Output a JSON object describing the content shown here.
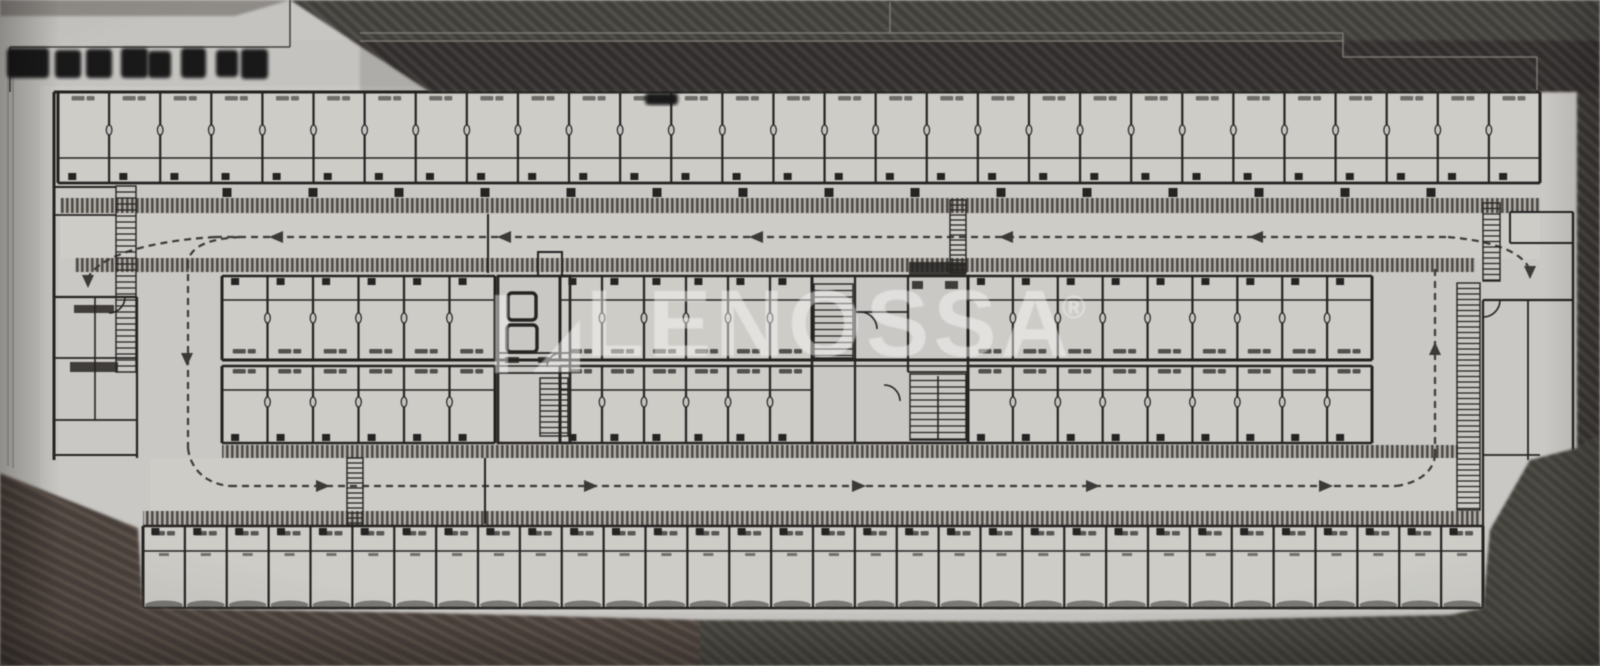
{
  "photo": {
    "description": "photographed architectural floor plan of a long storage-unit building with two drive aisles",
    "watermark": {
      "text": "LENOSSA",
      "registered_symbol": "®",
      "logo": "lenossa-mark",
      "color": "#ffffff",
      "opacity": 0.45
    },
    "redactions": {
      "title_block_blobs": 8,
      "unit_label_blobs": 1,
      "note": "title text blacked out"
    },
    "labels_note": "all unit labels are tiny and illegible smudges"
  },
  "colors": {
    "paper": "#c7c5c1",
    "paper_light": "#cccac6",
    "unit_fill": "#d3d1cc",
    "ink": "#23211f",
    "ink_soft": "#3a3836",
    "smudge": "#3b3936",
    "band_bg": "#b7b3ae",
    "band_tick": "#4e4a45",
    "hatch_top_bg": "#34322f",
    "hatch_top_line": "#524d48",
    "hatch_brown_bg": "#473d37",
    "hatch_brown_line": "#65564d",
    "hatch_olive_bg": "#3f3e38",
    "hatch_olive_line": "#56544b",
    "faint_line": "#857f78",
    "crisp_line": "#45433f",
    "redaction": "#131216",
    "gray_strip": "#8a8682",
    "shadow_blob": "#33312c"
  },
  "plan": {
    "canvas": {
      "w": 1600,
      "h": 666
    },
    "base_rect": [
      40,
      86,
      1537,
      527
    ],
    "aisle_fills": [
      [
        60,
        214,
        1480,
        45
      ],
      [
        150,
        458,
        1330,
        54
      ]
    ],
    "rows": [
      {
        "name": "top-units",
        "segments": [
          [
            58,
            1540,
            29
          ]
        ],
        "y0": 92,
        "y1": 183,
        "inner_line_y": 158,
        "label_y": 96,
        "label_opacity": 0.65,
        "tick_y": 173,
        "oval_y": 130
      },
      {
        "name": "mid-upper-units",
        "segments": [
          [
            222,
            495,
            6
          ],
          [
            560,
            812,
            6
          ],
          [
            968,
            1372,
            9
          ]
        ],
        "y0": 276,
        "y1": 360,
        "inner_line_y": 300,
        "label_y": 349,
        "label_opacity": 0.85,
        "tick_y": 278,
        "oval_y": 318
      },
      {
        "name": "mid-lower-units",
        "segments": [
          [
            222,
            495,
            6
          ],
          [
            560,
            812,
            6
          ],
          [
            968,
            1372,
            9
          ]
        ],
        "y0": 366,
        "y1": 443,
        "inner_line_y": 390,
        "label_y": 369,
        "label_opacity": 0.85,
        "tick_y": 434,
        "oval_y": 402
      },
      {
        "name": "bottom-units",
        "segments": [
          [
            143,
            1483,
            32
          ]
        ],
        "y0": 526,
        "y1": 608,
        "inner_line_y": 551,
        "label_y": 531,
        "label_opacity": 0.8,
        "tick_y": 528,
        "dash_y": 553,
        "shadow_y": 605
      }
    ],
    "hatch_bands": [
      [
        60,
        198,
        1480,
        15
      ],
      [
        75,
        258,
        1400,
        14
      ],
      [
        222,
        445,
        1236,
        13
      ],
      [
        143,
        511,
        1338,
        14
      ]
    ],
    "nub_ticks": {
      "y": 188,
      "size": 9,
      "xs": [
        227,
        313,
        399,
        485,
        571,
        657,
        743,
        829,
        915,
        1001,
        1087,
        1173,
        1259,
        1345,
        1431
      ]
    },
    "routes": [
      "M 215 237 H 1448",
      "M 240 237 C 205 239 190 248 188 262",
      "M 188 262 V 448",
      "M 188 448 C 190 468 205 484 230 486",
      "M 230 486 H 1396",
      "M 1396 486 C 1418 483 1433 472 1435 456",
      "M 1435 456 V 268",
      "M 215 237 C 152 241 103 254 89 276",
      "M 1448 237 C 1494 241 1521 252 1529 268"
    ],
    "arrows": [
      {
        "x": 277,
        "y": 237,
        "dir": "left"
      },
      {
        "x": 505,
        "y": 237,
        "dir": "left"
      },
      {
        "x": 757,
        "y": 237,
        "dir": "left"
      },
      {
        "x": 1007,
        "y": 237,
        "dir": "left"
      },
      {
        "x": 1257,
        "y": 237,
        "dir": "left"
      },
      {
        "x": 322,
        "y": 486,
        "dir": "right"
      },
      {
        "x": 590,
        "y": 486,
        "dir": "right"
      },
      {
        "x": 858,
        "y": 486,
        "dir": "right"
      },
      {
        "x": 1092,
        "y": 486,
        "dir": "right"
      },
      {
        "x": 1325,
        "y": 486,
        "dir": "right"
      },
      {
        "x": 88,
        "y": 280,
        "dir": "down"
      },
      {
        "x": 1530,
        "y": 271,
        "dir": "down"
      },
      {
        "x": 187,
        "y": 358,
        "dir": "down"
      },
      {
        "x": 1435,
        "y": 350,
        "dir": "up"
      }
    ],
    "walls": [
      [
        54,
        92,
        1540,
        92,
        3
      ],
      [
        54,
        92,
        54,
        460,
        3
      ],
      [
        58,
        183,
        1540,
        183,
        2.4
      ],
      [
        1540,
        92,
        1540,
        183,
        2.4
      ],
      [
        222,
        360,
        1372,
        360,
        3
      ],
      [
        222,
        366,
        1372,
        366,
        1.6
      ],
      [
        488,
        214,
        488,
        273,
        2
      ],
      [
        485,
        458,
        485,
        524,
        2
      ],
      [
        855,
        276,
        855,
        443,
        2.2
      ],
      [
        908,
        276,
        908,
        372,
        2.2
      ],
      [
        855,
        312,
        908,
        312,
        1.8
      ],
      [
        908,
        372,
        968,
        372,
        1.8
      ],
      [
        938,
        376,
        938,
        440,
        1.6
      ],
      [
        498,
        353,
        570,
        353,
        1.8
      ],
      [
        498,
        373,
        570,
        373,
        1.8
      ],
      [
        53,
        187,
        116,
        187,
        2
      ],
      [
        53,
        215,
        116,
        215,
        1.8
      ],
      [
        53,
        297,
        137,
        297,
        2.2
      ],
      [
        137,
        297,
        137,
        458,
        2.2
      ],
      [
        53,
        358,
        137,
        358,
        1.8
      ],
      [
        53,
        420,
        137,
        420,
        1.8
      ],
      [
        53,
        455,
        137,
        455,
        2
      ],
      [
        95,
        297,
        95,
        420,
        1.6
      ],
      [
        1483,
        300,
        1573,
        300,
        2.2
      ],
      [
        1483,
        300,
        1483,
        528,
        2.2
      ],
      [
        1573,
        212,
        1573,
        450,
        2.4
      ],
      [
        1528,
        300,
        1528,
        460,
        1.8
      ],
      [
        1483,
        455,
        1540,
        455,
        1.8
      ],
      [
        1510,
        212,
        1573,
        212,
        2
      ],
      [
        1510,
        212,
        1510,
        243,
        2
      ],
      [
        1510,
        243,
        1573,
        243,
        2
      ]
    ],
    "stroke_rects": [
      [
        812,
        276,
        156,
        167,
        0,
        2.6
      ],
      [
        498,
        276,
        72,
        167,
        0,
        2.6
      ],
      [
        538,
        252,
        24,
        24,
        0,
        2
      ],
      [
        508,
        293,
        28,
        27,
        4,
        3.4
      ],
      [
        507,
        325,
        30,
        27,
        4,
        3.4
      ]
    ],
    "ladders": [
      [
        814,
        284,
        39,
        74,
        6.5
      ],
      [
        910,
        374,
        56,
        66,
        6.5
      ],
      [
        540,
        378,
        28,
        58,
        5.5
      ],
      [
        116,
        186,
        20,
        186,
        6
      ],
      [
        1457,
        283,
        23,
        227,
        5.5
      ],
      [
        1483,
        203,
        17,
        78,
        5.5
      ],
      [
        347,
        458,
        16,
        67,
        5
      ],
      [
        950,
        200,
        16,
        73,
        5
      ]
    ],
    "door_arcs": [
      "M 860 312 a 17 17 0 0 1 17 17",
      "M 884 385 a 16 16 0 0 1 16 16",
      "M 1500 300 a 17 17 0 0 1 -17 17",
      "M 125 297 a 16 16 0 0 1 -16 16",
      "M 547 367 a 14 14 0 0 1 14 -14"
    ],
    "black_bits": [
      [
        909,
        262,
        57,
        13
      ],
      [
        912,
        281,
        11,
        8
      ],
      [
        945,
        281,
        13,
        8
      ],
      [
        505,
        357,
        14,
        6
      ],
      [
        538,
        357,
        11,
        6
      ],
      [
        70,
        362,
        48,
        10
      ],
      [
        74,
        305,
        40,
        8
      ]
    ],
    "dark_regions": [
      {
        "pattern": "top",
        "points": "290,0 1600,0 1600,92 430,92"
      },
      {
        "pattern": "top",
        "points": "1577,92 1600,92 1600,435 1577,448"
      },
      {
        "pattern": "brown",
        "points": "0,473 138,528 143,608 430,613 700,620 700,666 0,666"
      },
      {
        "pattern": "olive",
        "points": "700,620 1090,622 1450,615 1483,608 1490,530 1530,460 1577,448 1600,435 1600,666 700,666"
      }
    ],
    "gray_strip_points": "0,0 290,0 235,16 0,16",
    "faint_lines": [
      "M 360 33 H 1343",
      "M 360 41 H 1343",
      "M 1343 33 V 57",
      "M 1343 57 H 1537",
      "M 1537 57 V 90",
      "M 890 2 V 33"
    ],
    "crisp_lines": [
      "M 10 47 H 290",
      "M 290 0 V 47",
      "M 10 47 V 92"
    ],
    "paper_edge_lines": [
      "M 8 52 V 466",
      "M 13 55 V 468"
    ],
    "redaction_blobs": [
      [
        7,
        48,
        42,
        30
      ],
      [
        55,
        50,
        26,
        28
      ],
      [
        86,
        49,
        26,
        29
      ],
      [
        121,
        48,
        27,
        30
      ],
      [
        148,
        51,
        23,
        27
      ],
      [
        181,
        48,
        25,
        30
      ],
      [
        216,
        50,
        22,
        27
      ],
      [
        241,
        49,
        27,
        30
      ],
      [
        645,
        93,
        33,
        12
      ]
    ],
    "watermark_geom": {
      "bar": [
        495,
        295,
        13,
        78
      ],
      "tri": "533,372 580,372 580,320",
      "text_x": 586,
      "text_y": 356,
      "font_size": 95,
      "reg_x": 1062,
      "reg_y": 318,
      "reg_size": 32
    }
  }
}
